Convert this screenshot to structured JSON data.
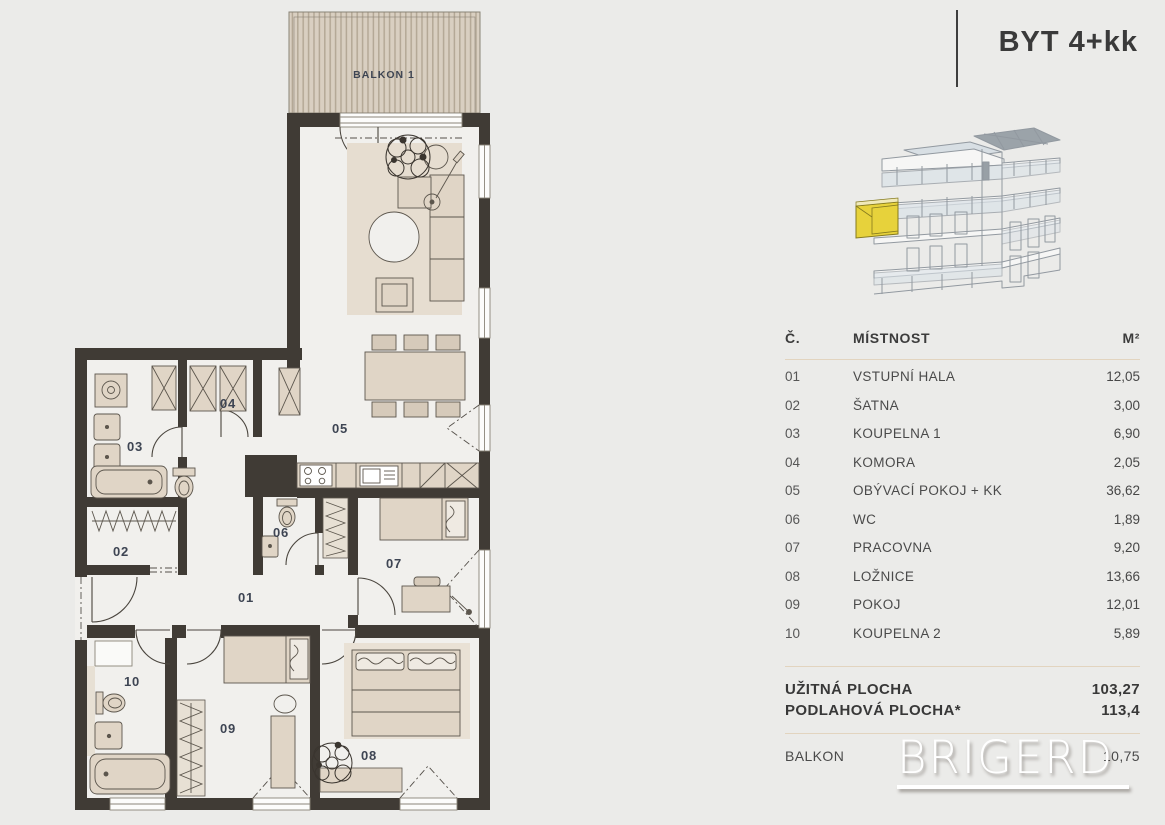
{
  "unit": {
    "title": "BYT 4+kk"
  },
  "plan": {
    "balcony_label": "BALKON 1",
    "rooms": [
      {
        "id": "01"
      },
      {
        "id": "02"
      },
      {
        "id": "03"
      },
      {
        "id": "04"
      },
      {
        "id": "05"
      },
      {
        "id": "06"
      },
      {
        "id": "07"
      },
      {
        "id": "08"
      },
      {
        "id": "09"
      },
      {
        "id": "10"
      }
    ]
  },
  "table": {
    "headers": {
      "num": "Č.",
      "name": "MÍSTNOST",
      "area": "M²"
    },
    "rows": [
      {
        "num": "01",
        "name": "VSTUPNÍ HALA",
        "area": "12,05"
      },
      {
        "num": "02",
        "name": "ŠATNA",
        "area": "3,00"
      },
      {
        "num": "03",
        "name": "KOUPELNA 1",
        "area": "6,90"
      },
      {
        "num": "04",
        "name": "KOMORA",
        "area": "2,05"
      },
      {
        "num": "05",
        "name": "OBÝVACÍ POKOJ + KK",
        "area": "36,62"
      },
      {
        "num": "06",
        "name": "WC",
        "area": "1,89"
      },
      {
        "num": "07",
        "name": "PRACOVNA",
        "area": "9,20"
      },
      {
        "num": "08",
        "name": "LOŽNICE",
        "area": "13,66"
      },
      {
        "num": "09",
        "name": "POKOJ",
        "area": "12,01"
      },
      {
        "num": "10",
        "name": "KOUPELNA 2",
        "area": "5,89"
      }
    ],
    "totals": [
      {
        "label": "UŽITNÁ PLOCHA",
        "value": "103,27"
      },
      {
        "label": "PODLAHOVÁ PLOCHA*",
        "value": "113,4"
      }
    ],
    "balcony_row": {
      "label": "BALKON",
      "value": "10,75"
    }
  },
  "watermark": {
    "text": "BRIGERD"
  },
  "colors": {
    "background": "#EBEBE9",
    "wall": "#403B35",
    "floor": "#F1F0ED",
    "furniture": "#E0D5C6",
    "accent_yellow": "#E7D23B",
    "rule": "#E2D4BF",
    "label": "#3E4553"
  }
}
